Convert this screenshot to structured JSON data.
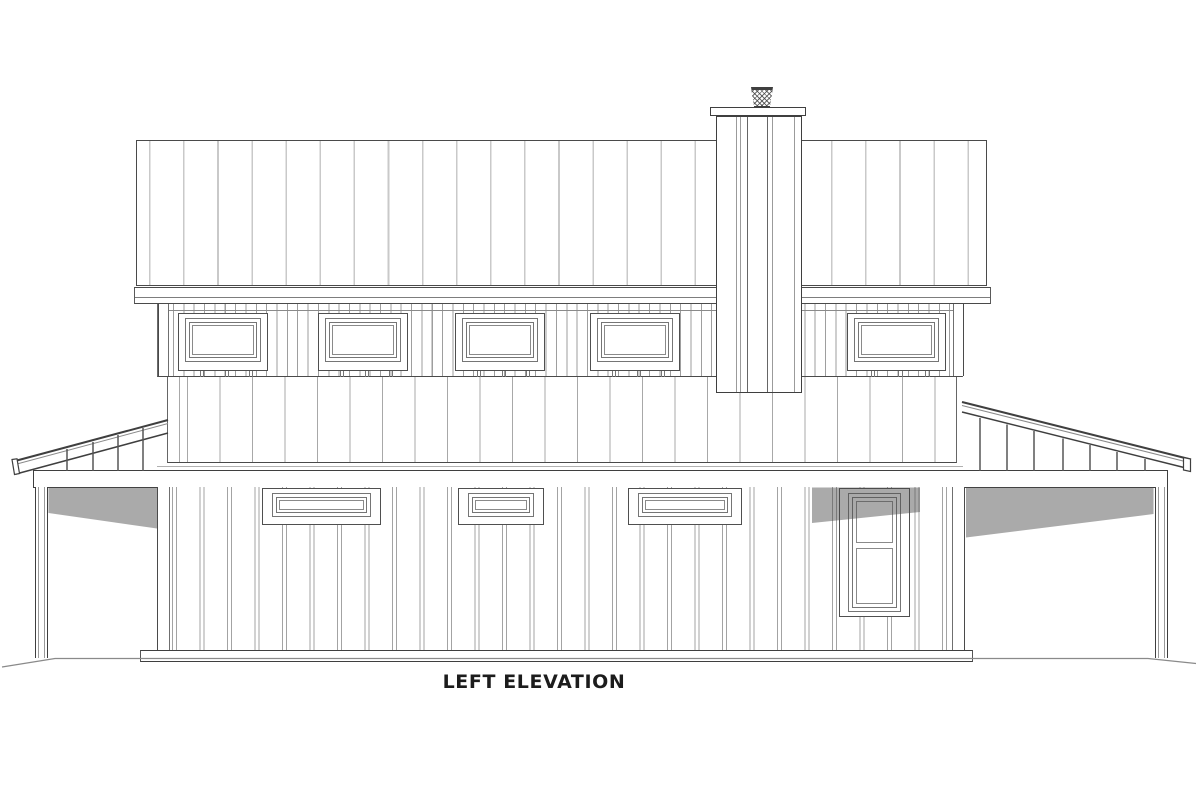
{
  "label": {
    "title": "LEFT ELEVATION"
  },
  "drawing": {
    "colors": {
      "outline": "#3f3f3f",
      "mid": "#6e6e6e",
      "light": "#c9c9c9",
      "shadow_fill": "rgba(75,75,75,0.47)",
      "ground": "#8a8a8a"
    },
    "upper_windows": {
      "y": 313,
      "h": 58,
      "items": [
        {
          "x": 178,
          "w": 90
        },
        {
          "x": 318,
          "w": 90
        },
        {
          "x": 455,
          "w": 90
        },
        {
          "x": 590,
          "w": 90
        },
        {
          "x": 847,
          "w": 99
        }
      ],
      "tick_fracs": [
        0.24,
        0.275,
        0.52,
        0.555,
        0.79,
        0.825
      ],
      "tick_y": 371
    },
    "lower_windows": {
      "y": 488,
      "h": 37,
      "items": [
        {
          "x": 262,
          "w": 119
        },
        {
          "x": 458,
          "w": 86
        },
        {
          "x": 628,
          "w": 114
        }
      ]
    },
    "door": {
      "x": 839,
      "y": 488,
      "w": 71,
      "h": 129,
      "pane1_h": 42,
      "rail_h": 5
    },
    "chimney_lines": [
      {
        "x": 736,
        "c": "#9b9b9b"
      },
      {
        "x": 740,
        "c": "#9b9b9b"
      },
      {
        "x": 747,
        "c": "#666666"
      },
      {
        "x": 767,
        "c": "#666666"
      },
      {
        "x": 772,
        "c": "#9b9b9b"
      },
      {
        "x": 794,
        "c": "#9b9b9b"
      }
    ],
    "porch_left": {
      "lines": [
        {
          "x1": 15,
          "y1": 461,
          "x2": 168,
          "y2": 420,
          "w": 2,
          "c": "#3f3f3f"
        },
        {
          "x1": 15,
          "y1": 464.5,
          "x2": 168,
          "y2": 423.5,
          "w": 1,
          "c": "#8a8a8a"
        },
        {
          "x1": 16,
          "y1": 474,
          "x2": 168,
          "y2": 433,
          "w": 1.5,
          "c": "#3f3f3f"
        }
      ],
      "endcap": "12,459.5 17,458.8 19.5,473.5 14.5,474.5",
      "rafters": [
        {
          "x": 67,
          "y1": 449
        },
        {
          "x": 93,
          "y1": 442
        },
        {
          "x": 118,
          "y1": 435
        },
        {
          "x": 143,
          "y1": 428
        }
      ]
    },
    "porch_right": {
      "lines": [
        {
          "x1": 962,
          "y1": 402,
          "x2": 1191,
          "y2": 459.5,
          "w": 2,
          "c": "#3f3f3f"
        },
        {
          "x1": 962,
          "y1": 405.5,
          "x2": 1191,
          "y2": 463,
          "w": 1,
          "c": "#8a8a8a"
        },
        {
          "x1": 962,
          "y1": 412,
          "x2": 1184,
          "y2": 467.5,
          "w": 1.5,
          "c": "#3f3f3f"
        }
      ],
      "endcap": "1183.5,457.5 1190.5,459 1190.5,471.5 1183.5,470",
      "rafters": [
        {
          "x": 980,
          "y1": 418
        },
        {
          "x": 1007,
          "y1": 424.5
        },
        {
          "x": 1034,
          "y1": 431
        },
        {
          "x": 1063,
          "y1": 438.5
        },
        {
          "x": 1090,
          "y1": 445
        },
        {
          "x": 1117,
          "y1": 452
        },
        {
          "x": 1145,
          "y1": 459
        }
      ]
    },
    "rafter_bottom_y": 471,
    "shadows": [
      "48.5,487.5 157,487.5 157,528.5 48.5,513",
      "812,487.5 920,487.5 920,512 812,523",
      "966,487.5 1153.5,487.5 1153.5,514 966,537.5"
    ],
    "ground_line": "2,667 55,658.5 1148,658.5 1196,663.5"
  }
}
